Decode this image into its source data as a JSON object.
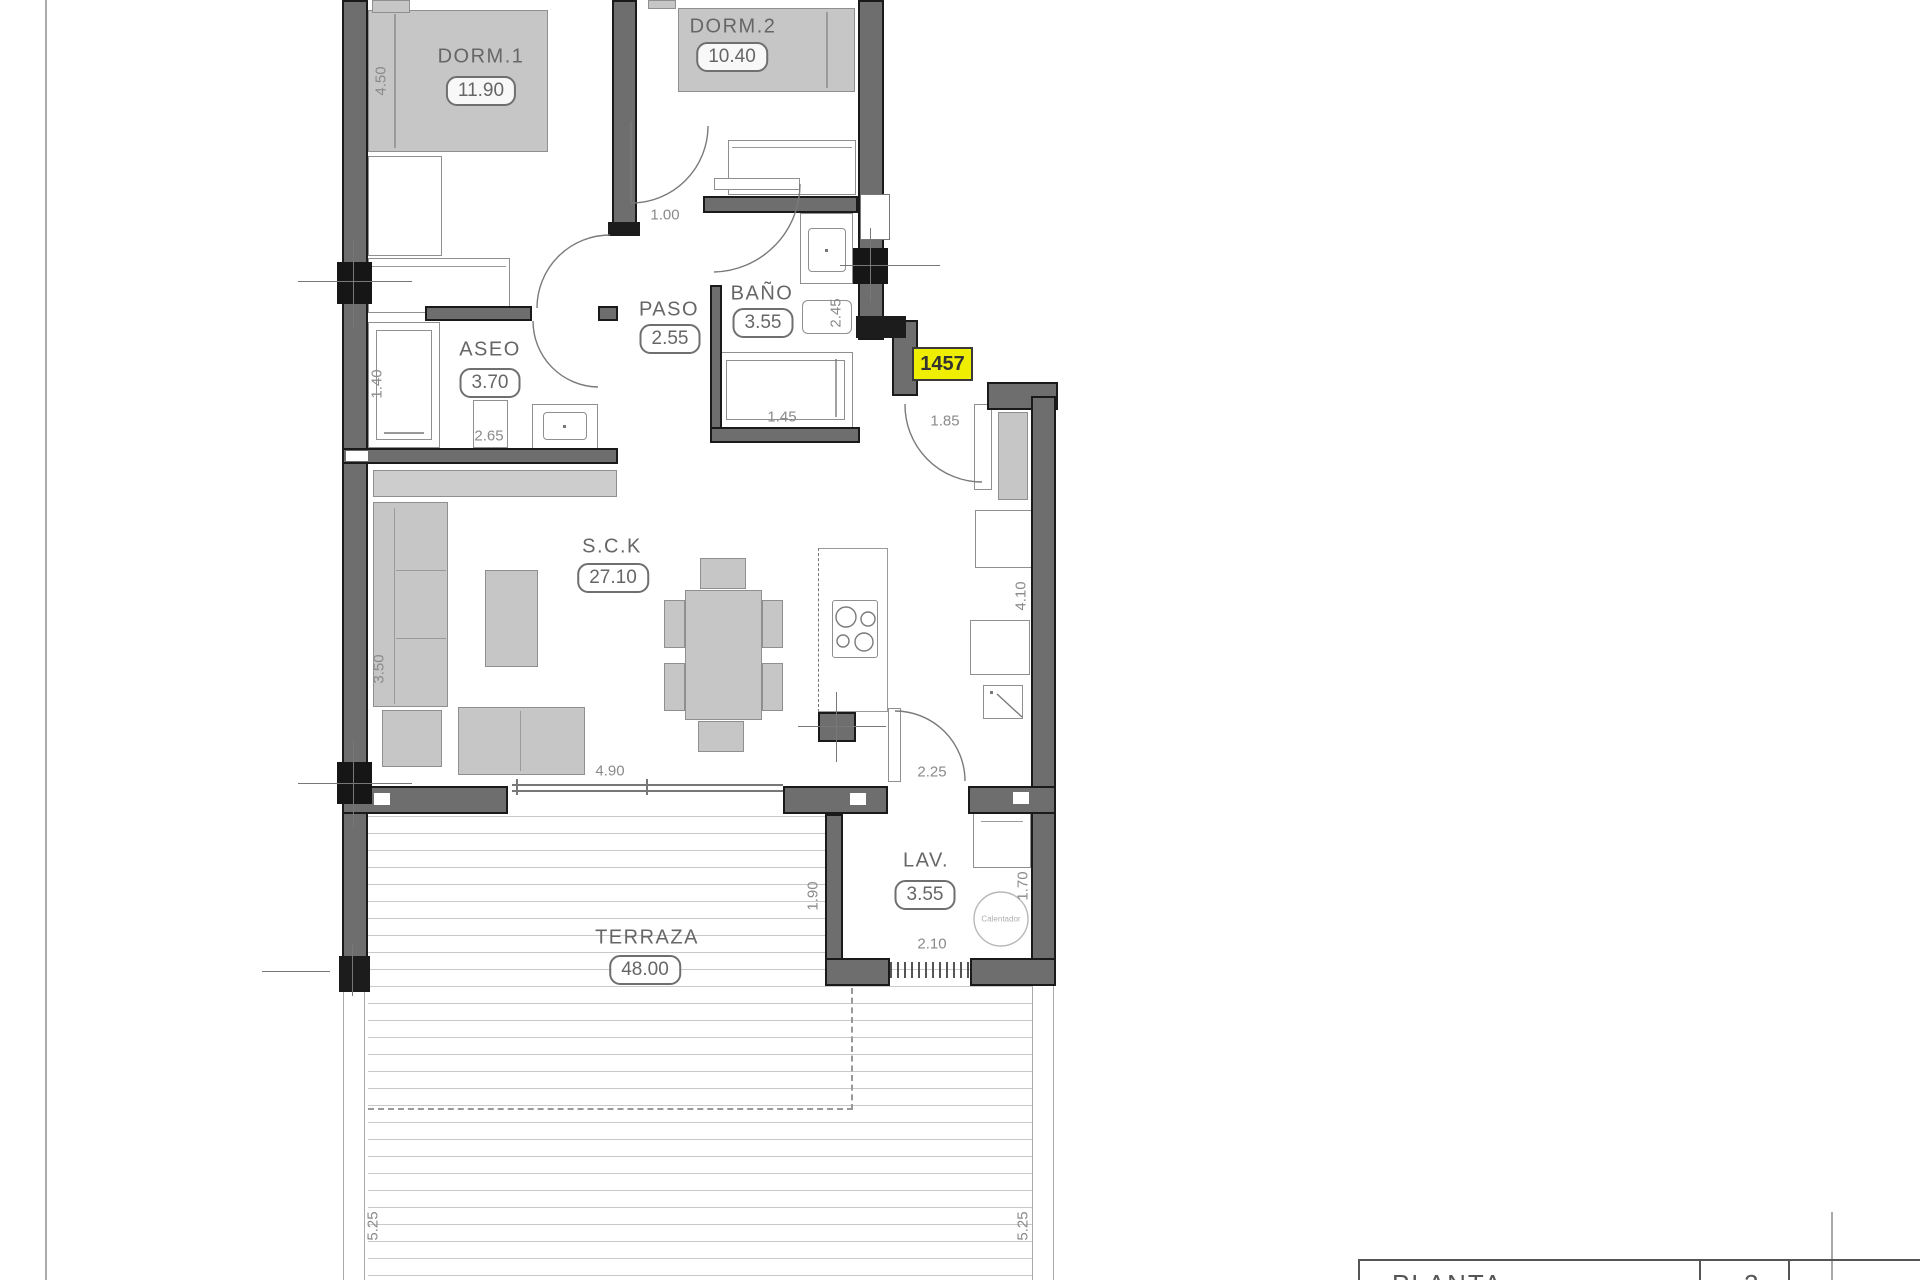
{
  "unit_badge": "1457",
  "rooms": [
    {
      "name": "DORM.1",
      "area": "11.90"
    },
    {
      "name": "DORM.2",
      "area": "10.40"
    },
    {
      "name": "PASO",
      "area": "2.55"
    },
    {
      "name": "BAÑO",
      "area": "3.55"
    },
    {
      "name": "ASEO",
      "area": "3.70"
    },
    {
      "name": "S.C.K",
      "area": "27.10"
    },
    {
      "name": "LAV.",
      "area": "3.55"
    },
    {
      "name": "TERRAZA",
      "area": "48.00"
    }
  ],
  "dimensions": [
    {
      "v": "4.50"
    },
    {
      "v": "1.00"
    },
    {
      "v": "2.45"
    },
    {
      "v": "1.40"
    },
    {
      "v": "2.65"
    },
    {
      "v": "1.45"
    },
    {
      "v": "1.85"
    },
    {
      "v": "3.50"
    },
    {
      "v": "4.10"
    },
    {
      "v": "4.90"
    },
    {
      "v": "2.25"
    },
    {
      "v": "1.90"
    },
    {
      "v": "1.70"
    },
    {
      "v": "2.10"
    },
    {
      "v": "5.25"
    },
    {
      "v": "5.25"
    }
  ],
  "equipment": {
    "water_heater_label": "Calentador"
  },
  "title_block": {
    "partial_title": "PLANTA",
    "partial_number": "2"
  },
  "colors": {
    "wall": "#6e6e6e",
    "wall_outline": "#1a1a1a",
    "furniture": "#c6c6c6",
    "badge_bg": "#f0ee00",
    "dim_text": "#8a8a8a"
  }
}
